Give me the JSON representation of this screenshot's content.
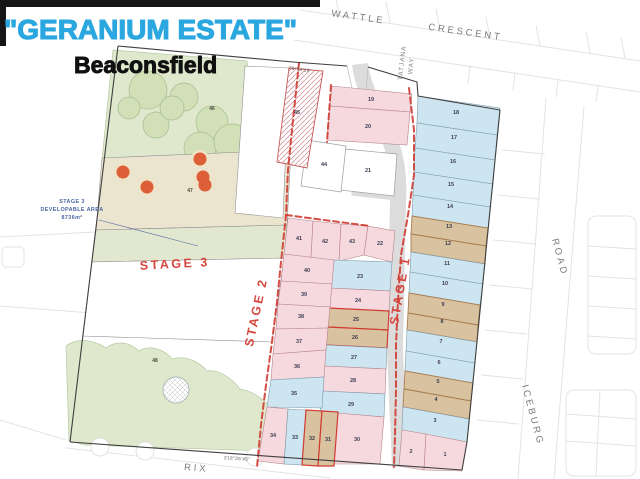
{
  "page": {
    "title_estate": "\"GERANIUM ESTATE\"",
    "title_suburb": "Beaconsfield"
  },
  "streets": {
    "wattle": "WATTLE",
    "crescent": "CRESCENT",
    "tatjana": "TATJANA",
    "way": "WAY",
    "road": "ROAD",
    "iceburg": "ICEBURG",
    "rix": "RIX"
  },
  "stage_labels": {
    "s1": "STAGE 1",
    "s2": "STAGE 2",
    "s3": "STAGE 3"
  },
  "annotation": {
    "l1": "STAGE 3",
    "l2": "DEVELOPABLE AREA",
    "l3": "8736m²"
  },
  "bearings": {
    "top": "78°54'10\"",
    "bottom": "218°26'45\""
  },
  "palette": {
    "title_blue": "#2ba7e0",
    "stage_red": "#d5473e",
    "lot_pink": "#f6d9de",
    "lot_blue": "#cde4f1",
    "lot_tan": "#d9c29f",
    "open_green": "#dfe8cd",
    "road_grey": "#dcdcdc",
    "dash_red": "#cf3b32",
    "tree_dot_orange": "#dd5f38"
  },
  "lots": {
    "stage1": [
      "18",
      "17",
      "16",
      "15",
      "14",
      "13",
      "12",
      "11",
      "10",
      "9",
      "8",
      "7",
      "6",
      "5",
      "4",
      "3",
      "2",
      "1"
    ],
    "mid_right": [
      "22",
      "23",
      "24",
      "25",
      "26",
      "27",
      "28",
      "29",
      "30"
    ],
    "mid_left_top": [
      "41",
      "42",
      "43"
    ],
    "mid_left": [
      "40",
      "39",
      "38",
      "37",
      "36",
      "35"
    ],
    "mid_bottom": [
      "34",
      "33",
      "32",
      "31"
    ],
    "north": [
      "19",
      "20",
      "21",
      "44",
      "45"
    ],
    "open_space": [
      "46",
      "47",
      "48"
    ]
  }
}
